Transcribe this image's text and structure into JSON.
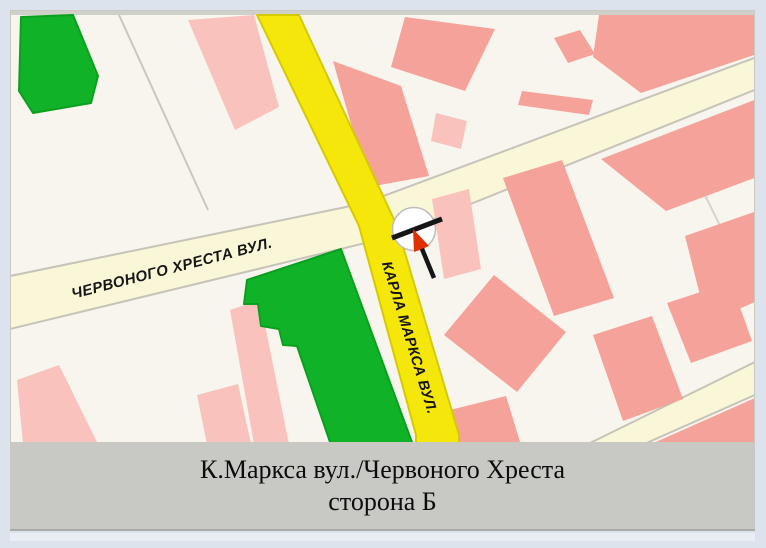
{
  "caption": {
    "line1": "К.Маркса вул./Червоного Хреста",
    "line2": "сторона Б"
  },
  "streets": {
    "chervonoho_khresta": "ЧЕРВОНОГО ХРЕСТА ВУЛ.",
    "karla_marksa": "КАРЛА МАРКСА ВУЛ."
  },
  "icons": {
    "marker": "location-direction-marker"
  },
  "colors": {
    "frame_border": "#dde3ed",
    "map_background": "#f8f5ee",
    "building_medium": "#f5a29b",
    "building_light": "#f9c2bc",
    "park_green": "#10b228",
    "park_green_edge": "#0aa01f",
    "road_yellow": "#f6e70a",
    "road_yellow_edge": "#d5ca00",
    "road_pale": "#faf7d8",
    "road_pale_edge": "#c6c3b8",
    "parcel_line": "#c9c7c0",
    "caption_bar": "#c8c8c4",
    "marker_arrow_red": "#e13000",
    "marker_line_black": "#161616",
    "label_text": "#161616",
    "caption_text": "#0c0c0c"
  }
}
